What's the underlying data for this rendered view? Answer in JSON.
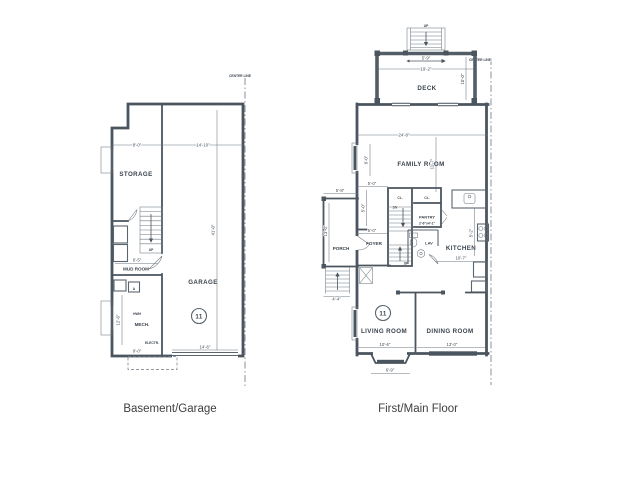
{
  "captions": {
    "basement": "Basement/Garage",
    "main": "First/Main Floor"
  },
  "basement": {
    "center_line": "CENTER LINE",
    "marker": "11",
    "rooms": {
      "storage": "STORAGE",
      "mud_room": "MUD ROOM",
      "garage": "GARAGE",
      "mech": "MECH.",
      "electrical": "ELECTR.",
      "water_heater": "HWH",
      "appliance": "A"
    },
    "stairs": {
      "up": "UP"
    },
    "dims": {
      "storage_width": "8'-0\"",
      "right_width": "14'-10\"",
      "mud_room_width": "6'-5\"",
      "mech_width": "9'-0\"",
      "garage_door": "14'-6\"",
      "depth": "41'-0\"",
      "mech_depth": "12'-6\""
    }
  },
  "main_floor": {
    "center_line": "CENTER LINE",
    "marker": "11",
    "rooms": {
      "deck": "DECK",
      "family_room": "FAMILY ROOM",
      "kitchen": "KITCHEN",
      "foyer": "FOYER",
      "porch": "PORCH",
      "pantry": "PANTRY",
      "lav": "LAV",
      "living_room": "LIVING ROOM",
      "dining_room": "DINING ROOM",
      "closet_left": "CL.",
      "closet_right": "CL."
    },
    "stairs": {
      "down": "DN",
      "up": "UP",
      "deck_up": "UP"
    },
    "dims": {
      "deck_stair_width": "5'-9\"",
      "deck_width": "19'-2\"",
      "deck_depth": "10'-0\"",
      "overall_width": "24'-8\"",
      "family_side": "6'-0\"",
      "family_depth": "11'-7\"",
      "foyer_top": "5'-0\"",
      "foyer_side": "5'-0\"",
      "foyer_bottom": "5'-0\"",
      "porch_width": "5'-8\"",
      "porch_depth": "13'-0\"",
      "porch_stairs": "4'-4\"",
      "kitchen_width": "10'-7\"",
      "kitchen_side": "5'-2\"",
      "pantry": "2'-6\"x4'-1\"",
      "living_width": "10'-6\"",
      "dining_width": "13'-0\"",
      "bay_width": "6'-9\""
    }
  }
}
